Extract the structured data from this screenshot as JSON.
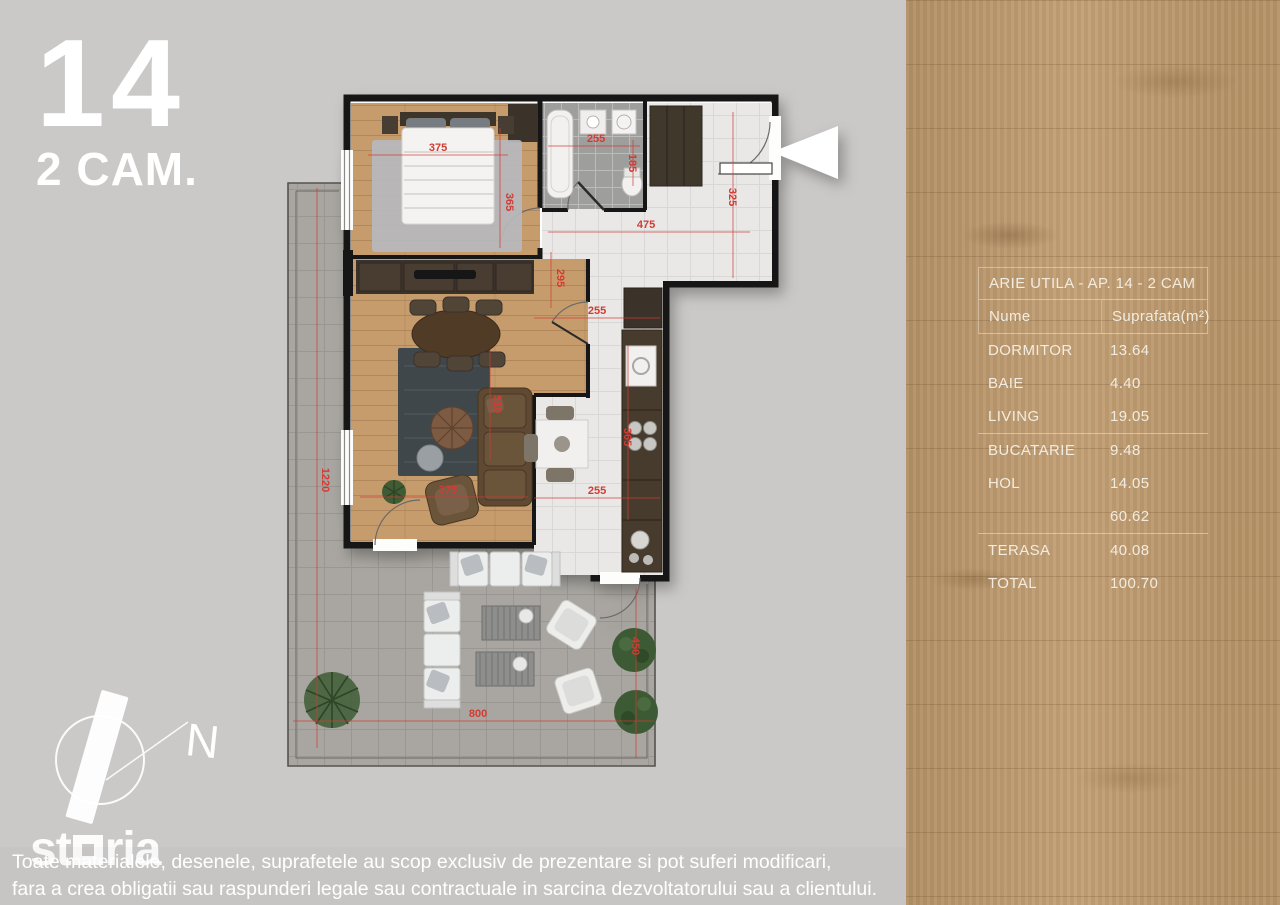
{
  "apartment": {
    "number": "14",
    "type_label": "2 CAM."
  },
  "area_table": {
    "title": "ARIE UTILA - AP. 14 - 2 CAM",
    "columns": {
      "name": "Nume",
      "area": "Suprafata(m²)"
    },
    "rows": [
      {
        "name": "DORMITOR",
        "value": "13.64"
      },
      {
        "name": "BAIE",
        "value": "4.40"
      },
      {
        "name": "LIVING",
        "value": "19.05"
      },
      {
        "name": "BUCATARIE",
        "value": "9.48"
      },
      {
        "name": "HOL",
        "value": "14.05"
      },
      {
        "name": "",
        "value": "60.62"
      },
      {
        "name": "TERASA",
        "value": "40.08"
      },
      {
        "name": "TOTAL",
        "value": "100.70"
      }
    ]
  },
  "floorplan": {
    "compass_north": "N",
    "dimensions": [
      {
        "text": "375",
        "x": 438,
        "y": 151,
        "rot": 0
      },
      {
        "text": "365",
        "x": 506,
        "y": 202,
        "rot": 90
      },
      {
        "text": "255",
        "x": 596,
        "y": 142,
        "rot": 0
      },
      {
        "text": "185",
        "x": 629,
        "y": 163,
        "rot": 90
      },
      {
        "text": "475",
        "x": 646,
        "y": 228,
        "rot": 0
      },
      {
        "text": "325",
        "x": 729,
        "y": 197,
        "rot": 90
      },
      {
        "text": "295",
        "x": 557,
        "y": 278,
        "rot": 90
      },
      {
        "text": "255",
        "x": 597,
        "y": 314,
        "rot": 0
      },
      {
        "text": "365",
        "x": 624,
        "y": 437,
        "rot": 90
      },
      {
        "text": "255",
        "x": 597,
        "y": 494,
        "rot": 0
      },
      {
        "text": "375",
        "x": 448,
        "y": 493,
        "rot": 0
      },
      {
        "text": "510",
        "x": 494,
        "y": 404,
        "rot": 90
      },
      {
        "text": "1220",
        "x": 322,
        "y": 480,
        "rot": 90
      },
      {
        "text": "800",
        "x": 478,
        "y": 717,
        "rot": 0
      },
      {
        "text": "450",
        "x": 632,
        "y": 646,
        "rot": 90
      }
    ]
  },
  "watermark": {
    "brand": "storia"
  },
  "disclaimer": {
    "line1": "Toate materialele, desenele, suprafetele au scop exclusiv de prezentare si pot suferi modificari,",
    "line2": "fara a crea obligatii sau raspunderi legale sau contractuale in sarcina dezvoltatorului sau a clientului."
  },
  "colors": {
    "background": "#cbc9c8",
    "wood_panel": "#bf9a6d",
    "wall": "#181818",
    "dimension_red": "#d23b33",
    "table_text": "#f2ecdf",
    "wood_floor": "#c79c6d",
    "hall_tile": "#e9e8e6",
    "bath_tile": "#9e9e9c",
    "terrace_paving": "#a9a6a1"
  }
}
